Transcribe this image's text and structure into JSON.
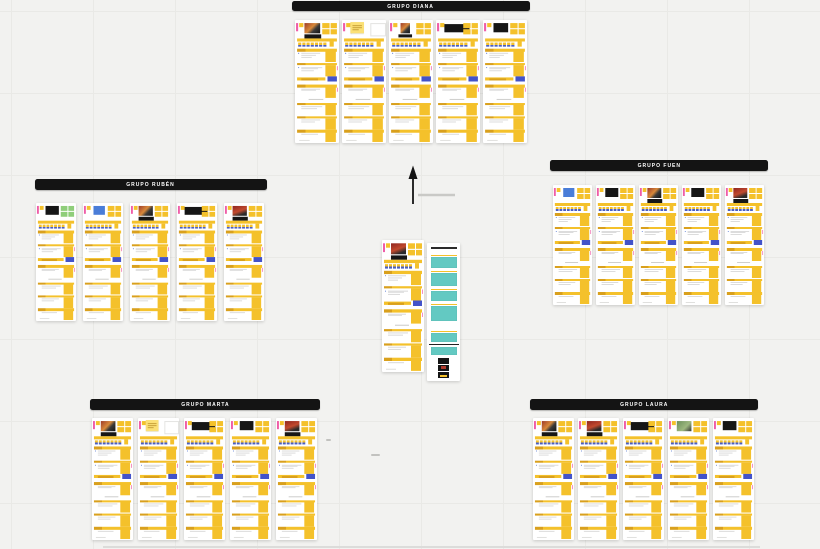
{
  "canvas": {
    "width": 820,
    "height": 549,
    "background": "#f2f2f0",
    "grid_color": "#e9e9e6",
    "grid_size": 82
  },
  "palette": {
    "sticky": "#f4c12b",
    "sticky_dark": "#d9a01d",
    "sticky_note": "#fbe076",
    "sticky_green": "#8fce7a",
    "scale_blue": "#4a5ec4",
    "blue_rect": "#4353c9",
    "teal": "#63c9c2",
    "pink": "#ef5da8",
    "dark": "#161616",
    "line": "#dcdcdc",
    "dot_blue": "#4a6fd1",
    "thumb_photo": "#9c3a28",
    "thumb_photo_accent": "#d8893a",
    "thumb_red": "#8f2520",
    "thumb_green": "#6b8f5a",
    "thumb_blue": "#4a7dd8",
    "header_bg": "#141414",
    "header_text": "#ffffff",
    "board_bg": "#ffffff"
  },
  "groups": [
    {
      "label": "GRUPO DIANA",
      "header": {
        "x": 292,
        "y": 1,
        "w": 238,
        "h": 10
      },
      "board_area": {
        "y": 20,
        "w": 44,
        "h": 123
      },
      "board_x": [
        295,
        342,
        389,
        436,
        483
      ],
      "variants": [
        "photo",
        "note",
        "photo-small",
        "dark-wide",
        "dark"
      ],
      "top_stickies": [
        "yellow",
        "yellow",
        "yellow",
        "yellow",
        "yellow"
      ]
    },
    {
      "label": "GRUPO RUBÉN",
      "header": {
        "x": 35,
        "y": 179,
        "w": 232,
        "h": 11
      },
      "board_area": {
        "y": 203,
        "w": 40,
        "h": 118
      },
      "board_x": [
        36,
        83,
        130,
        177,
        224
      ],
      "variants": [
        "dark",
        "blue",
        "photo",
        "dark-wide",
        "photo-red"
      ],
      "top_stickies": [
        "green",
        "yellow",
        "yellow",
        "yellow",
        "yellow"
      ]
    },
    {
      "label": "GRUPO FUEN",
      "header": {
        "x": 550,
        "y": 160,
        "w": 218,
        "h": 11
      },
      "board_area": {
        "y": 185,
        "w": 39,
        "h": 120
      },
      "board_x": [
        553,
        596,
        639,
        682,
        725
      ],
      "variants": [
        "blue",
        "dark",
        "photo",
        "dark",
        "photo-red"
      ],
      "top_stickies": [
        "yellow",
        "yellow",
        "yellow",
        "yellow",
        "yellow"
      ]
    },
    {
      "label": "GRUPO MARTA",
      "header": {
        "x": 90,
        "y": 399,
        "w": 230,
        "h": 11
      },
      "board_area": {
        "y": 418,
        "w": 41,
        "h": 122
      },
      "board_x": [
        92,
        138,
        184,
        230,
        276
      ],
      "variants": [
        "photo",
        "note",
        "dark-wide",
        "dark",
        "photo-red"
      ],
      "top_stickies": [
        "yellow",
        "yellow",
        "yellow",
        "yellow",
        "yellow"
      ]
    },
    {
      "label": "GRUPO LAURA",
      "header": {
        "x": 530,
        "y": 399,
        "w": 228,
        "h": 11
      },
      "board_area": {
        "y": 418,
        "w": 41,
        "h": 122
      },
      "board_x": [
        533,
        578,
        623,
        668,
        713
      ],
      "variants": [
        "photo",
        "photo-red",
        "dark-wide",
        "photo-green",
        "dark"
      ],
      "top_stickies": [
        "yellow",
        "yellow",
        "yellow",
        "yellow",
        "yellow"
      ]
    }
  ],
  "center_board": {
    "x": 382,
    "y": 240,
    "w": 42,
    "h": 132,
    "variant": "photo-red",
    "top_stickies": "yellow"
  },
  "ideas_panel": {
    "x": 427,
    "y": 243,
    "w": 33,
    "h": 138,
    "items": [
      {
        "type": "title"
      },
      {
        "type": "teal",
        "strip": true,
        "y": 12,
        "h": 11
      },
      {
        "type": "teal",
        "strip": true,
        "y": 28,
        "h": 13
      },
      {
        "type": "teal",
        "strip": true,
        "y": 46,
        "h": 10
      },
      {
        "type": "teal",
        "strip": true,
        "y": 61,
        "h": 15
      },
      {
        "type": "teal",
        "strip": true,
        "y": 88,
        "h": 9
      },
      {
        "type": "divider",
        "y": 100.5,
        "h": 1.8
      },
      {
        "type": "teal",
        "strip": false,
        "y": 104,
        "h": 8
      },
      {
        "type": "thumb",
        "y": 115,
        "accent": "none"
      },
      {
        "type": "thumb",
        "y": 122,
        "accent": "red"
      },
      {
        "type": "thumb",
        "y": 129,
        "accent": "yellow"
      }
    ]
  },
  "arrow": {
    "x": 402,
    "y": 164,
    "w": 60,
    "h": 44,
    "color": "#141414",
    "line_color": "#c9c9c6"
  },
  "specks": [
    {
      "x": 326,
      "y": 439,
      "w": 5,
      "h": 2
    },
    {
      "x": 371,
      "y": 454,
      "w": 9,
      "h": 2
    }
  ],
  "baseline": {
    "x": 103,
    "y": 546,
    "w": 657,
    "h": 2,
    "color": "#dcdcda"
  }
}
